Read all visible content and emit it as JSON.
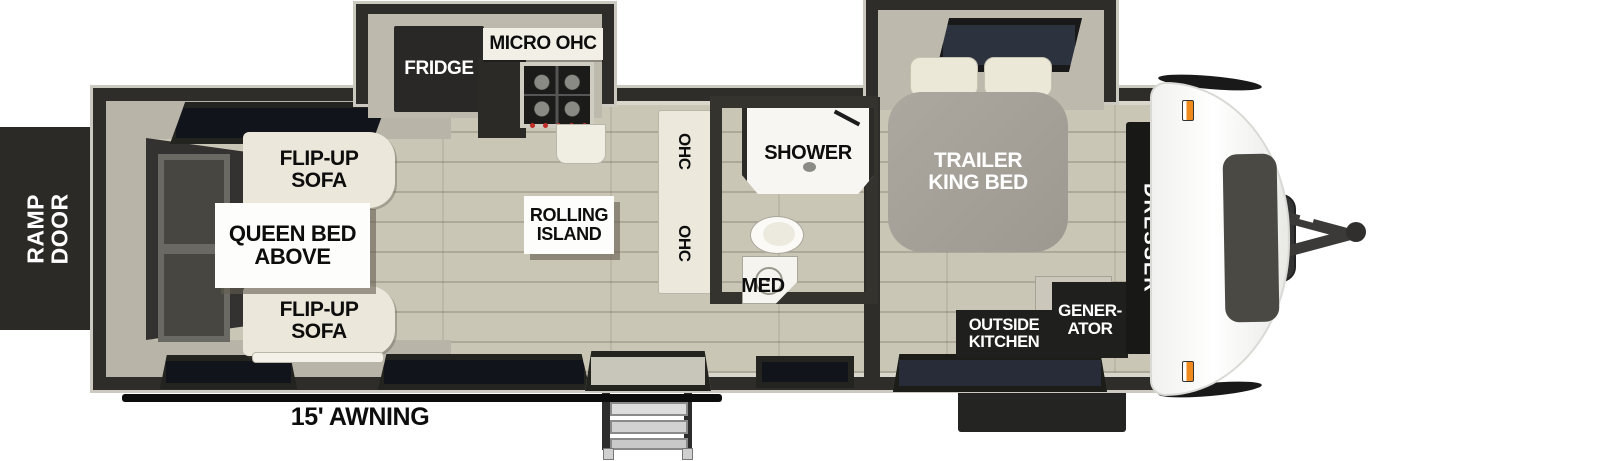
{
  "colors": {
    "wall": "#2f2d29",
    "wall-light": "#bdb9ad",
    "floor": "#cac6b5",
    "cream": "#ebe7da",
    "bed": "#a5a19a",
    "orange": "#f08a1d"
  },
  "labels": {
    "ramp_door": "RAMP\nDOOR",
    "flip_up_sofa": "FLIP-UP\nSOFA",
    "queen_bed_above": "QUEEN BED\nABOVE",
    "fridge": "FRIDGE",
    "micro_ohc": "MICRO OHC",
    "rolling_island": "ROLLING\nISLAND",
    "ohc": "OHC",
    "shower": "SHOWER",
    "med": "MED",
    "trailer_king_bed": "TRAILER\nKING BED",
    "dresser": "DRESSER",
    "outside_kitchen": "OUTSIDE\nKITCHEN",
    "generator": "GENER-\nATOR",
    "awning": "15' AWNING"
  }
}
